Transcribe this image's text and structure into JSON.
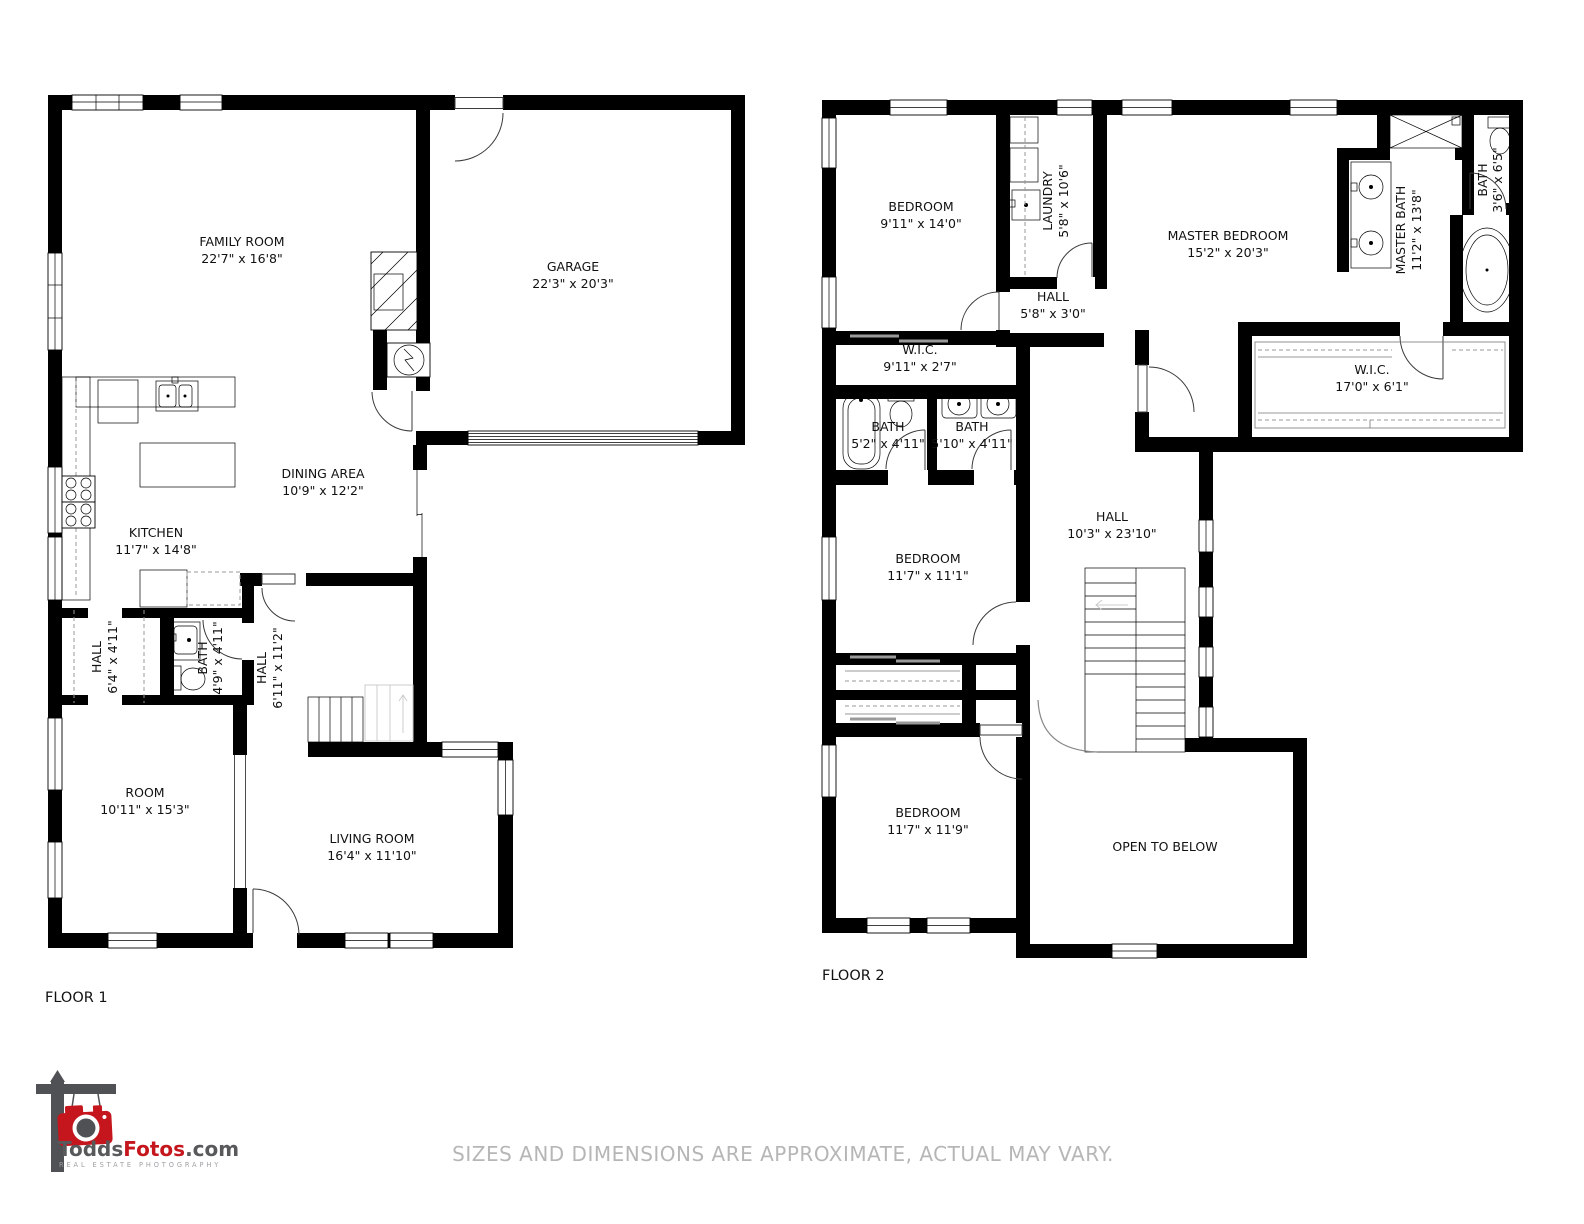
{
  "page": {
    "background": "#ffffff"
  },
  "floor1": {
    "title": "FLOOR 1",
    "rooms": {
      "family_room": {
        "name": "FAMILY ROOM",
        "dims": "22'7\" x 16'8\""
      },
      "garage": {
        "name": "GARAGE",
        "dims": "22'3\" x 20'3\""
      },
      "dining_area": {
        "name": "DINING AREA",
        "dims": "10'9\" x 12'2\""
      },
      "kitchen": {
        "name": "KITCHEN",
        "dims": "11'7\" x 14'8\""
      },
      "hall_a": {
        "name": "HALL",
        "dims": "6'4\" x 4'11\""
      },
      "bath": {
        "name": "BATH",
        "dims": "4'9\" x 4'11\""
      },
      "hall_b": {
        "name": "HALL",
        "dims": "6'11\" x 11'2\""
      },
      "room": {
        "name": "ROOM",
        "dims": "10'11\" x 15'3\""
      },
      "living_room": {
        "name": "LIVING ROOM",
        "dims": "16'4\" x 11'10\""
      }
    }
  },
  "floor2": {
    "title": "FLOOR 2",
    "rooms": {
      "bedroom_front": {
        "name": "BEDROOM",
        "dims": "9'11\" x 14'0\""
      },
      "laundry": {
        "name": "LAUNDRY",
        "dims": "5'8\" x 10'6\""
      },
      "master_bedroom": {
        "name": "MASTER BEDROOM",
        "dims": "15'2\" x 20'3\""
      },
      "master_bath": {
        "name": "MASTER BATH",
        "dims": "11'2\" x 13'8\""
      },
      "bath_small": {
        "name": "BATH",
        "dims": "3'6\" x 6'5\""
      },
      "hall_small": {
        "name": "HALL",
        "dims": "5'8\" x 3'0\""
      },
      "wic_small": {
        "name": "W.I.C.",
        "dims": "9'11\" x 2'7\""
      },
      "bath_tub": {
        "name": "BATH",
        "dims": "5'2\" x 4'11\""
      },
      "bath_sinks": {
        "name": "BATH",
        "dims": "5'10\" x 4'11\""
      },
      "wic_master": {
        "name": "W.I.C.",
        "dims": "17'0\" x 6'1\""
      },
      "bedroom_mid": {
        "name": "BEDROOM",
        "dims": "11'7\" x 11'1\""
      },
      "hall_main": {
        "name": "HALL",
        "dims": "10'3\" x 23'10\""
      },
      "bedroom_back": {
        "name": "BEDROOM",
        "dims": "11'7\" x 11'9\""
      },
      "open_below": {
        "name": "OPEN TO BELOW"
      }
    }
  },
  "logo": {
    "brand_part1": "Todds",
    "brand_part2": "Fotos",
    "brand_part3": ".com",
    "tagline": "REAL ESTATE PHOTOGRAPHY",
    "accent_color": "#c4161c",
    "gray_color": "#58595b"
  },
  "footer": {
    "disclaimer": "SIZES AND DIMENSIONS ARE APPROXIMATE, ACTUAL MAY VARY."
  }
}
